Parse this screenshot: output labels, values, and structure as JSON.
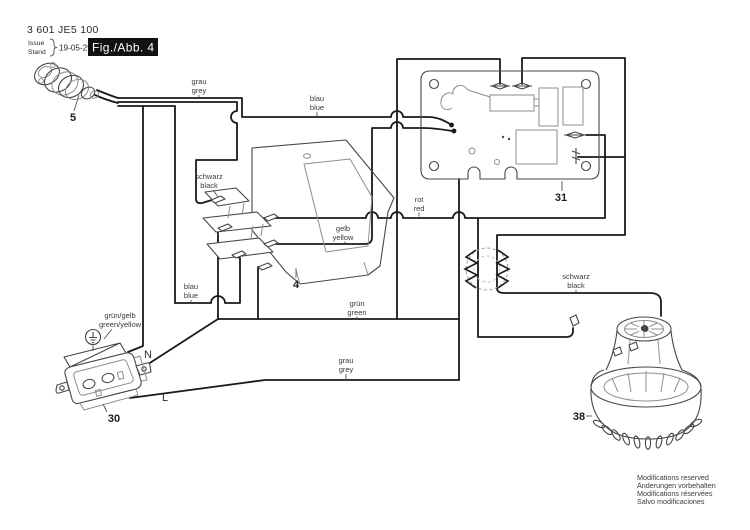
{
  "header": {
    "part_number": "3 601 JE5 100",
    "issue_label": "Issue",
    "stand_label": "Stand",
    "date": "19-05-29",
    "figure_label": "Fig./Abb. 4"
  },
  "footer": {
    "lines": [
      "Modifications reserved",
      "Änderungen vorbehalten",
      "Modifications réservées",
      "Salvo modificaciones"
    ]
  },
  "wire_labels": {
    "grau_top": {
      "l1": "grau",
      "l2": "grey"
    },
    "blau_top": {
      "l1": "blau",
      "l2": "blue"
    },
    "schwarz_switch": {
      "l1": "schwarz",
      "l2": "black"
    },
    "gelb": {
      "l1": "gelb",
      "l2": "yellow"
    },
    "blau_lower": {
      "l1": "blau",
      "l2": "blue"
    },
    "gruen": {
      "l1": "grün",
      "l2": "green"
    },
    "rot": {
      "l1": "rot",
      "l2": "red"
    },
    "grau_lower": {
      "l1": "grau",
      "l2": "grey"
    },
    "schwarz_motor": {
      "l1": "schwarz",
      "l2": "black"
    },
    "gruengelb": {
      "l1": "grün/gelb",
      "l2": "green/yellow"
    }
  },
  "terminals": {
    "neutral": "N",
    "live": "L"
  },
  "part_numbers": {
    "plug": "5",
    "switch": "4",
    "socket": "30",
    "pcb": "31",
    "motor": "38"
  },
  "colors": {
    "wire": "#1a1a1c",
    "label": "#3a3a3c",
    "component": "#46464c",
    "figbox": "#111111"
  }
}
